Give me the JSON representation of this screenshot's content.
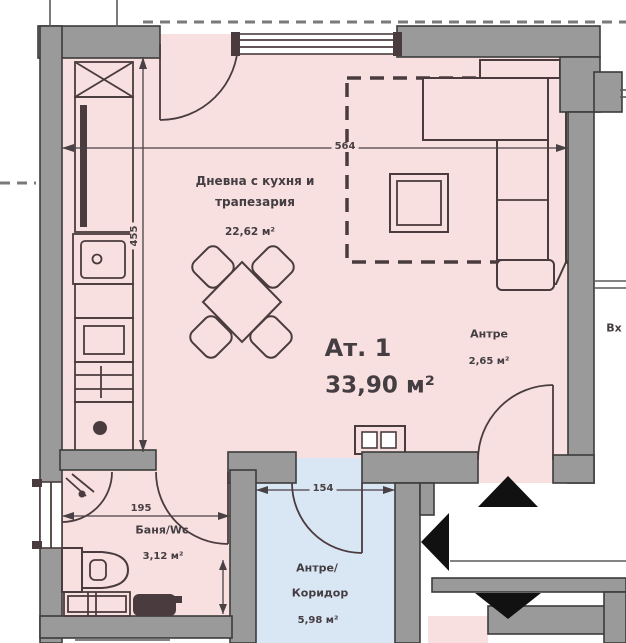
{
  "plan": {
    "rooms": {
      "living": {
        "name_line1": "Дневна с кухня и",
        "name_line2": "трапезария",
        "area": "22,62 м²"
      },
      "apartment": {
        "name": "Ат. 1",
        "area": "33,90 м²"
      },
      "hall": {
        "name": "Антре",
        "area": "2,65 м²"
      },
      "bathroom": {
        "name": "Баня/Wc",
        "area": "3,12 м²"
      },
      "corridor": {
        "name_line1": "Антре/",
        "name_line2": "Коридор",
        "area": "5,98 м²"
      }
    },
    "dimensions": {
      "living_width": "564",
      "living_height": "455",
      "bathroom_width": "195",
      "corridor_width": "154"
    },
    "edge_label": "Вх",
    "colors": {
      "room_fill": "#f8e0e1",
      "corridor_fill": "#d9e6f4",
      "wall_fill": "#9a9a9a",
      "wall_stroke": "#3c3c3c",
      "line": "#4a3c3e",
      "dim": "#4a4145",
      "text": "#443d42",
      "arrow": "#111111"
    }
  }
}
